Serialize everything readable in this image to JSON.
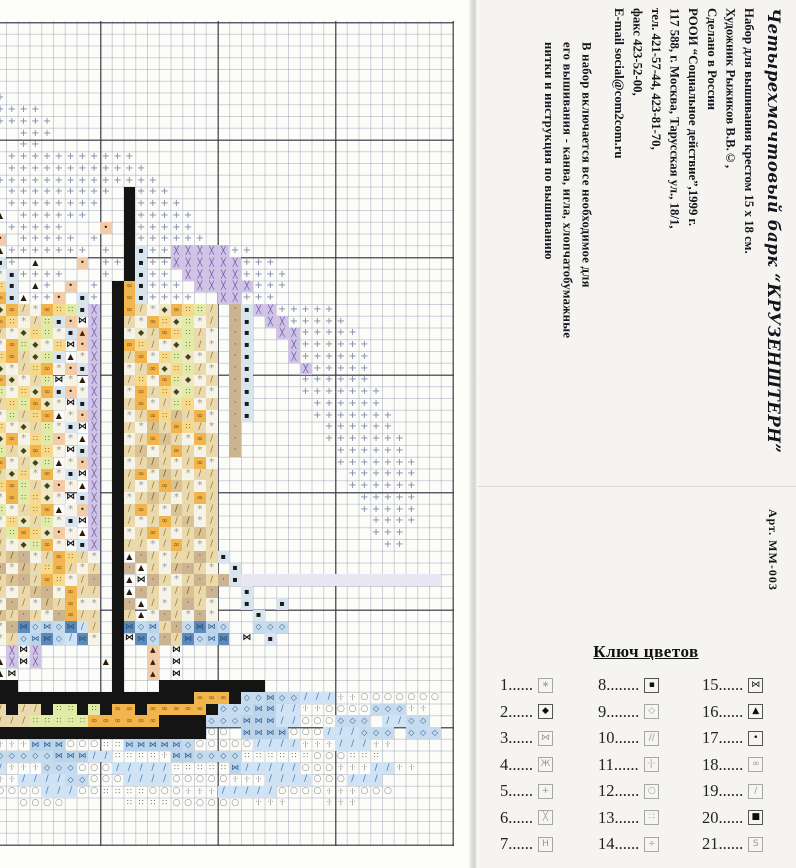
{
  "right_panel": {
    "title": "Четырехмачтовый  барк  “КРУЗЕНШТЕРН”",
    "art_number": "Арт. ММ-003",
    "info_lines": [
      "Набор для вышивания крестом 15 х 18 см.",
      "Художник Рыжиков В.В.©,",
      "Сделано в России",
      "РООИ “Социальное действие”,1999 г.",
      "117 588, г. Москва, Тарусская ул., 18/1,",
      "тел.   421-57-44, 423-81-70,",
      "факс 423-52-00,",
      "E-mail   social@com2com.ru"
    ],
    "description_lines": [
      "В  набор  включается  все  необходимое  для",
      "его вышивания - канва, игла, хлопчатобумажные",
      "нитки  и  инструкция  по  вышиванию"
    ]
  },
  "legend": {
    "title": "Ключ цветов",
    "items": [
      {
        "label": "1......",
        "glyph": "∗",
        "dark": false
      },
      {
        "label": "2......",
        "glyph": "◆",
        "dark": true
      },
      {
        "label": "3......",
        "glyph": "⋈",
        "dark": false
      },
      {
        "label": "4......",
        "glyph": "Ж",
        "dark": false
      },
      {
        "label": "5......",
        "glyph": "+",
        "dark": false
      },
      {
        "label": "6......",
        "glyph": "╳",
        "dark": false
      },
      {
        "label": "7......",
        "glyph": "H",
        "dark": false
      },
      {
        "label": "8........",
        "glyph": "▪",
        "dark": true
      },
      {
        "label": "9........",
        "glyph": "◇",
        "dark": false
      },
      {
        "label": "10......",
        "glyph": "∕∕",
        "dark": false
      },
      {
        "label": "11......",
        "glyph": "·|·",
        "dark": false
      },
      {
        "label": "12......",
        "glyph": "○",
        "dark": false
      },
      {
        "label": "13......",
        "glyph": "∷",
        "dark": false
      },
      {
        "label": "14......",
        "glyph": "÷",
        "dark": false
      },
      {
        "label": "15......",
        "glyph": "⋈",
        "dark": true
      },
      {
        "label": "16......",
        "glyph": "▲",
        "dark": true
      },
      {
        "label": "17......",
        "glyph": "•",
        "dark": true
      },
      {
        "label": "18......",
        "glyph": "∞",
        "dark": false
      },
      {
        "label": "19......",
        "glyph": "∕",
        "dark": false
      },
      {
        "label": "20......",
        "glyph": "■",
        "dark": true
      },
      {
        "label": "21......",
        "glyph": "S",
        "dark": false
      }
    ]
  },
  "pattern": {
    "grid": {
      "rows": 70,
      "cols": 40,
      "cell_px": 11.75,
      "origin_x": -17.5,
      "origin_y": 22
    },
    "palette": {
      "+": {
        "glyph": "+",
        "fg": "#7d87a8",
        "fs": 10
      },
      "B": {
        "bg": "#141414"
      },
      "X": {
        "bg": "#cfc3e6",
        "glyph": "╳",
        "fg": "#6b4fa0",
        "fs": 8
      },
      "P": {
        "bg": "#e8d6ec",
        "glyph": "╳",
        "fg": "#9a6aa8",
        "fs": 8
      },
      "d": {
        "bg": "#d8e4ee",
        "glyph": "▪",
        "fg": "#1a1a1a",
        "fs": 8
      },
      "D": {
        "bg": "#efe6c4",
        "glyph": "◆",
        "fg": "#3f4416",
        "fs": 8
      },
      "g": {
        "bg": "#f2b54e",
        "glyph": "∞",
        "fg": "#8a5a10",
        "fs": 8
      },
      "y": {
        "bg": "#f6d98a",
        "glyph": "∷",
        "fg": "#8a5a00",
        "fs": 8
      },
      "G": {
        "bg": "#e2eaa8",
        "glyph": "∷",
        "fg": "#55641a",
        "fs": 8
      },
      "w": {
        "bg": "#f6f3e8",
        "glyph": "*",
        "fg": "#9a9a92",
        "fs": 10
      },
      "t": {
        "bg": "#ead9ad",
        "glyph": "/",
        "fg": "#9a7a33",
        "fs": 9
      },
      "T": {
        "bg": "#d9c193",
        "glyph": "/",
        "fg": "#7a5a28",
        "fs": 9
      },
      "n": {
        "bg": "#cdb490",
        "glyph": "·",
        "fg": "#5f452a",
        "fs": 9
      },
      "s": {
        "bg": "#f3cba6",
        "glyph": "▲",
        "fg": "#35200e",
        "fs": 7
      },
      "r": {
        "bg": "#f3cba6",
        "glyph": "•",
        "fg": "#35200e",
        "fs": 8
      },
      "A": {
        "glyph": "▲",
        "fg": "#2b1a0a",
        "fs": 8
      },
      "M": {
        "glyph": "⋈",
        "fg": "#141414",
        "fs": 9,
        "bold": true
      },
      "m": {
        "bg": "#bcd4ea",
        "glyph": "⋈",
        "fg": "#2f5e97",
        "fs": 8
      },
      "c": {
        "bg": "#c6dbee",
        "glyph": "◇",
        "fg": "#2f5e92",
        "fs": 8
      },
      "b": {
        "bg": "#cfe3f4",
        "glyph": "/",
        "fg": "#4a7ab2",
        "fs": 9
      },
      "u": {
        "bg": "#5d8ab8",
        "glyph": "⋈",
        "fg": "#27507e",
        "fs": 8
      },
      "O": {
        "glyph": "○",
        "fg": "#8a8a88",
        "fs": 9
      },
      ":": {
        "glyph": "∷",
        "fg": "#555555",
        "fs": 8
      },
      "i": {
        "glyph": "·|·",
        "fg": "#666666",
        "fs": 6
      },
      "e": {
        "bg": "#e9e5f3"
      }
    },
    "paint": [
      [
        5,
        0,
        "+"
      ],
      [
        6,
        0,
        "++"
      ],
      [
        7,
        0,
        "+++++"
      ],
      [
        8,
        0,
        "++++++"
      ],
      [
        9,
        3,
        "+++"
      ],
      [
        10,
        3,
        "++"
      ],
      [
        11,
        2,
        "+++++++++++"
      ],
      [
        12,
        0,
        "s.++++++++++++"
      ],
      [
        13,
        1,
        "++++++++++++++"
      ],
      [
        14,
        2,
        "+++++++++.B+++"
      ],
      [
        15,
        0,
        "d.++++++++..B++++"
      ],
      [
        16,
        0,
        "dA.++++++...B+++++"
      ],
      [
        17,
        0,
        "r.+++++...r.B+++++"
      ],
      [
        18,
        0,
        "tr.+++++.+..B++++++"
      ],
      [
        19,
        0,
        "wA+++++++.+.Bd++XXXXX++"
      ],
      [
        20,
        0,
        "gd+.A...r.++Bd++XXXXXX+++"
      ],
      [
        21,
        0,
        "Dwd++++...+.Bd++.XXXXX++++"
      ],
      [
        22,
        0,
        "gyd.A+.r.+.Bgd+++.XXXXX+++"
      ],
      [
        23,
        0,
        "wgdA++r.d+.Bgd++++..XX+++"
      ],
      [
        24,
        0,
        "wDgtwgyGdX.BgtwDgyGt.nd"
      ],
      [
        24,
        23,
        "XX+++++"
      ],
      [
        25,
        0,
        "DgywtGdrMX.BtwgyDGwt.nd"
      ],
      [
        25,
        24,
        "XX+++++"
      ],
      [
        26,
        0,
        "gtwDyGwdsX.BwDtgyGtw.nd"
      ],
      [
        26,
        25,
        "XX+++++"
      ],
      [
        27,
        0,
        "twgGDwyMrX.BgytwDGtw.nd"
      ],
      [
        27,
        25,
        ".X++++++"
      ],
      [
        28,
        0,
        "wygtDGdAwX.BtgwyGDwt.nd"
      ],
      [
        28,
        26,
        "X++++++"
      ],
      [
        29,
        0,
        "GDwtygwrdX.BwtgDyGtw.nd"
      ],
      [
        29,
        26,
        ".X+++++"
      ],
      [
        30,
        0,
        "ygDwtGMwAX.BtywgGDwt.nd"
      ],
      [
        30,
        27,
        "++++++"
      ],
      [
        31,
        0,
        "tGwyDgdrwX.BwgtyDGtw.nd"
      ],
      [
        31,
        27,
        "+++++++"
      ],
      [
        32,
        0,
        "wtyGgDwMdX.BtgwtGywt.nd"
      ],
      [
        32,
        28,
        "++++++"
      ],
      [
        33,
        0,
        "DwGtygAwrX.BwtgyTtgw.nd"
      ],
      [
        33,
        28,
        "+++++++"
      ],
      [
        34,
        0,
        "gywDtGwdMX.BtwTtgytw.n"
      ],
      [
        34,
        29,
        "++++++"
      ],
      [
        35,
        0,
        "tDgwyGrwAX.BwtgTtwgt.n"
      ],
      [
        35,
        29,
        "+++++++"
      ],
      [
        36,
        0,
        "wGtDgywMdX.BtTwtgtwt.n"
      ],
      [
        36,
        30,
        "++++++"
      ],
      [
        37,
        0,
        "ygwtDGAwrX.BwtTtwtgw"
      ],
      [
        37,
        30,
        "+++++++"
      ],
      [
        38,
        0,
        "GtDywgwdMX.BtgwTtwtt"
      ],
      [
        38,
        31,
        "++++++"
      ],
      [
        39,
        0,
        "wygGtDrwAX.BtwtgTtwt"
      ],
      [
        39,
        31,
        "++++++"
      ],
      [
        40,
        0,
        "twgGyDwMdX.BwtTtwtgt"
      ],
      [
        40,
        32,
        "+++++"
      ],
      [
        41,
        0,
        "DGwtygAwrX.BtgtwTtwt"
      ],
      [
        41,
        32,
        "+++++"
      ],
      [
        42,
        0,
        "gwyDtGwdMX.BtwtgtTwt"
      ],
      [
        42,
        33,
        "++++"
      ],
      [
        43,
        0,
        "wtGgyDrwAX.BwtgtwtTt"
      ],
      [
        43,
        33,
        "+++"
      ],
      [
        44,
        0,
        "ytwDGgwMdX.Bttwtgtwt"
      ],
      [
        44,
        34,
        "++"
      ],
      [
        45,
        0,
        "MtTnwtgytw.BAntwttntd"
      ],
      [
        46,
        0,
        "tnwTtygtwt.BnAtwTntw.d"
      ],
      [
        47,
        0,
        "wtTntgywtn.BAMntwtntnd"
      ],
      [
        47,
        22,
        "eeeeeeeeeeeeeeeee"
      ],
      [
        48,
        0,
        "ntwtTnwgtt.BAntwtTtn..d"
      ],
      [
        49,
        0,
        "twntwTtgww.BnAtwtntw"
      ],
      [
        49,
        22,
        "d"
      ],
      [
        49,
        25,
        "d"
      ],
      [
        50,
        0,
        "wTtntwngtt.BtAwntwnw"
      ],
      [
        50,
        23,
        "d"
      ],
      [
        51,
        0,
        "twnucmcubt.Bucmtncumc"
      ],
      [
        51,
        23,
        "ccc"
      ],
      [
        52,
        0,
        "nwtcmucbuw.BMucntucmu"
      ],
      [
        52,
        22,
        "M"
      ],
      [
        52,
        24,
        "d"
      ],
      [
        53,
        0,
        "A.XMX"
      ],
      [
        53,
        11,
        "B"
      ],
      [
        53,
        14,
        "s"
      ],
      [
        53,
        16,
        "M"
      ],
      [
        54,
        1,
        "AXMX"
      ],
      [
        54,
        10,
        "AB"
      ],
      [
        54,
        14,
        "s"
      ],
      [
        54,
        16,
        "M"
      ],
      [
        55,
        1,
        "AM"
      ],
      [
        55,
        11,
        "B"
      ],
      [
        55,
        14,
        "s"
      ],
      [
        55,
        16,
        "M"
      ],
      [
        56,
        0,
        "BBB"
      ],
      [
        56,
        11,
        "B"
      ],
      [
        56,
        15,
        "BBBBBBBBB"
      ],
      [
        57,
        1,
        "BBBBBBBBBBBBBBBBB"
      ],
      [
        57,
        18,
        "ggg"
      ],
      [
        57,
        21,
        "B"
      ],
      [
        57,
        22,
        "ccmccbbbiiOOOO"
      ],
      [
        57,
        36,
        "OOO"
      ],
      [
        58,
        0,
        "ttBttBGGBGBggBgggggBcccmmbbiiOOOOccc"
      ],
      [
        58,
        36,
        "ii"
      ],
      [
        59,
        0,
        "ttttGGGGGggggggBBBBcccmmmbbOOOccc"
      ],
      [
        59,
        34,
        "bbcc"
      ],
      [
        60,
        0,
        "BBBBBBBBBBBBBBBBBBBOO.mmmmOOObbbccc"
      ],
      [
        60,
        36,
        "ccc"
      ],
      [
        61,
        0,
        "iiiimmmOOO::mmmmmcOOOOObbbbiiibbb"
      ],
      [
        61,
        33,
        "ii"
      ],
      [
        62,
        0,
        "ccccccmmmbb::::immcccc::::::OOO:::"
      ],
      [
        63,
        0,
        "bbiiicccOOObbbbb:::::mbbbbbOOOiiibbii"
      ],
      [
        64,
        0,
        "iiibbbbccOOObbbbOOOOOiiibbbbOOObbb"
      ],
      [
        65,
        0,
        "cOOOObbbOO::::OOOiiibbbbbOOOOiiiOOO"
      ],
      [
        66,
        3,
        "OOOO"
      ],
      [
        66,
        12,
        "::::"
      ],
      [
        66,
        16,
        "OOOOOO"
      ],
      [
        66,
        23,
        "iii"
      ],
      [
        66,
        29,
        "iii"
      ]
    ]
  }
}
